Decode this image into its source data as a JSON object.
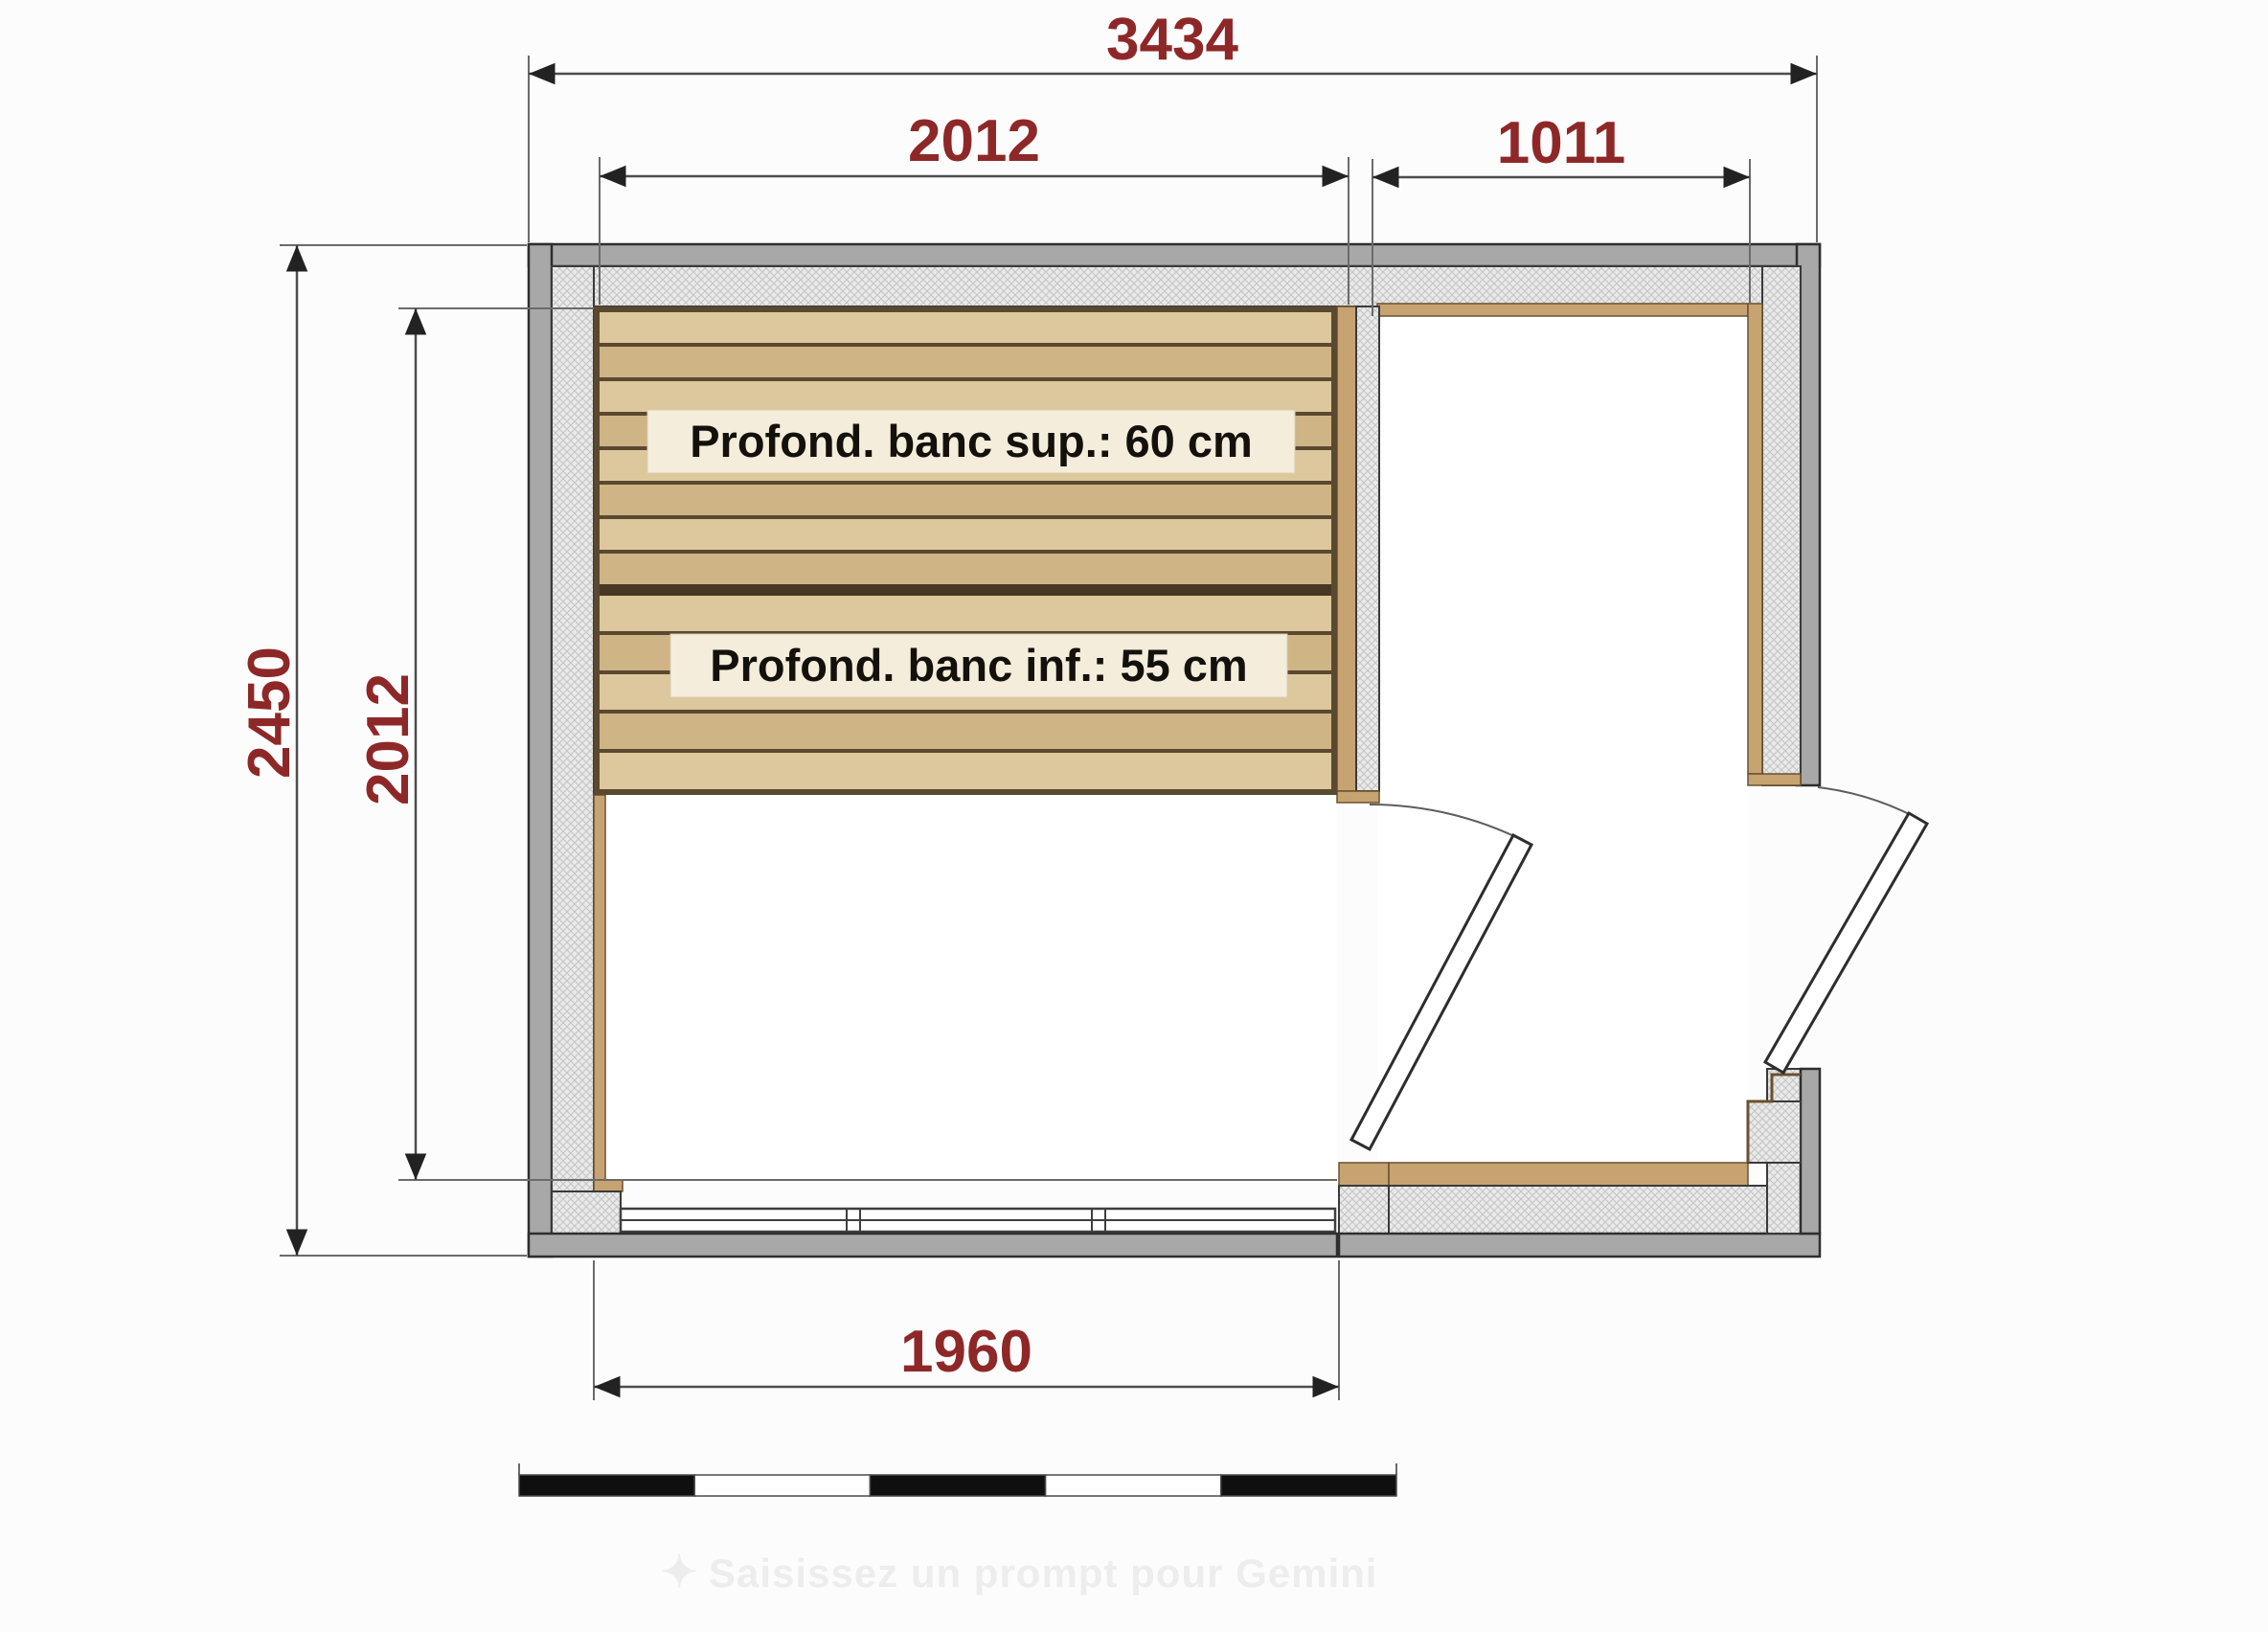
{
  "drawing": {
    "type": "sauna-floor-plan",
    "dimensions": {
      "overall_width_mm": "3434",
      "sauna_interior_width_mm": "2012",
      "vestibule_width_mm": "1011",
      "overall_depth_mm": "2450",
      "sauna_interior_depth_mm": "2012",
      "front_glazing_width_mm": "1960"
    },
    "bench_labels": {
      "upper": "Profond. banc sup.: 60 cm",
      "lower": "Profond. banc inf.: 55 cm"
    },
    "scale_bar": {
      "segments": 5
    },
    "watermark": {
      "icon": "✦",
      "text": "Saisissez un prompt pour Gemini"
    }
  },
  "colors": {
    "dimension_text": "#8e2828",
    "wall_gray": "#a8a8a8",
    "wall_hatch_bg": "#e9e9e9",
    "wood_trim": "#c7a372",
    "wood_plank_light": "#ddc79c",
    "wood_plank_dark": "#cfb486",
    "label_plate": "#f4eddb"
  }
}
